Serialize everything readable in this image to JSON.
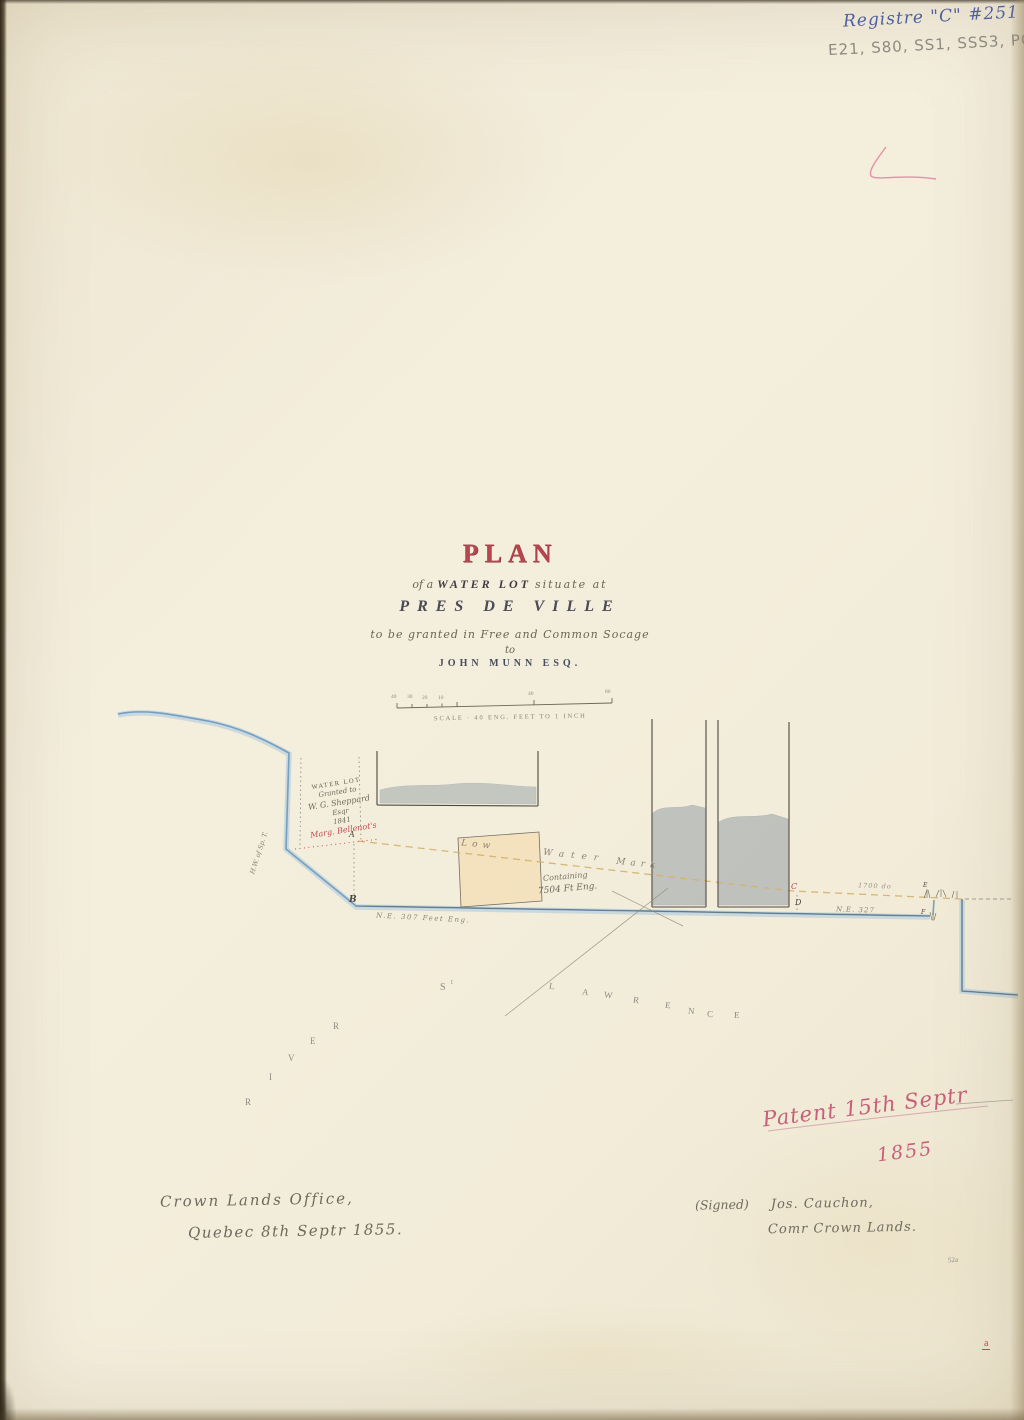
{
  "registre": "Registre \"C\"  #251",
  "codes": "E21, S80, SS1, SSS3, PC251",
  "title": {
    "plan": "PLAN",
    "l2a": "of a",
    "l2b": "WATER LOT",
    "l2c": "situate at",
    "l3": "PRES DE VILLE",
    "l4": "to be granted in Free and Common Socage",
    "l5": "to",
    "l6": "JOHN MUNN ESQ."
  },
  "scale": {
    "caption": "SCALE · 40 ENG. FEET TO 1 INCH",
    "ticks": [
      "40",
      "30",
      "20",
      "10",
      "40",
      "80"
    ]
  },
  "lot_label": {
    "l1": "WATER LOT",
    "l2": "Granted to",
    "l3": "W. G. Sheppard",
    "l4": "Esqr",
    "l5": "1841",
    "l6": "Marg. Bellenot's"
  },
  "shore_note": "H.W. of Sp. T.",
  "low_water": {
    "w1": "Low",
    "w2": "Water",
    "w3": "Mark"
  },
  "containing": {
    "l1": "Containing",
    "l2": "7504 Ft Eng."
  },
  "dims": {
    "left": "N.E. 307 Feet Eng.",
    "mid": "1700 do",
    "right": "N.E. 327"
  },
  "points": {
    "a": "A",
    "b": "B",
    "c": "C",
    "d": "D",
    "e": "E",
    "f": "F"
  },
  "river": {
    "s": "S",
    "t": "t",
    "lawrence": [
      "L",
      "A",
      "W",
      "R",
      "E",
      "N",
      "C",
      "E"
    ],
    "river": [
      "R",
      "I",
      "V",
      "E",
      "R"
    ]
  },
  "patent": {
    "l1": "Patent 15th Septr",
    "l2": "1855"
  },
  "footer": {
    "office1": "Crown Lands Office,",
    "office2": "Quebec 8th Septr 1855.",
    "signed": "(Signed)",
    "name": "Jos. Cauchon,",
    "title2": "Comr Crown Lands."
  },
  "marks": {
    "plate": "52a",
    "red": "a"
  },
  "colors": {
    "title_red": "#b5454f",
    "ink_blue": "#4a5fa8",
    "pencil": "#8f8b83",
    "water_blue": "#6d9cc0",
    "lot_buff": "#f3e2bb",
    "wharf_gray": "#96a0a6",
    "patent_pink": "#c75f7a",
    "script_red": "#c44a50"
  }
}
